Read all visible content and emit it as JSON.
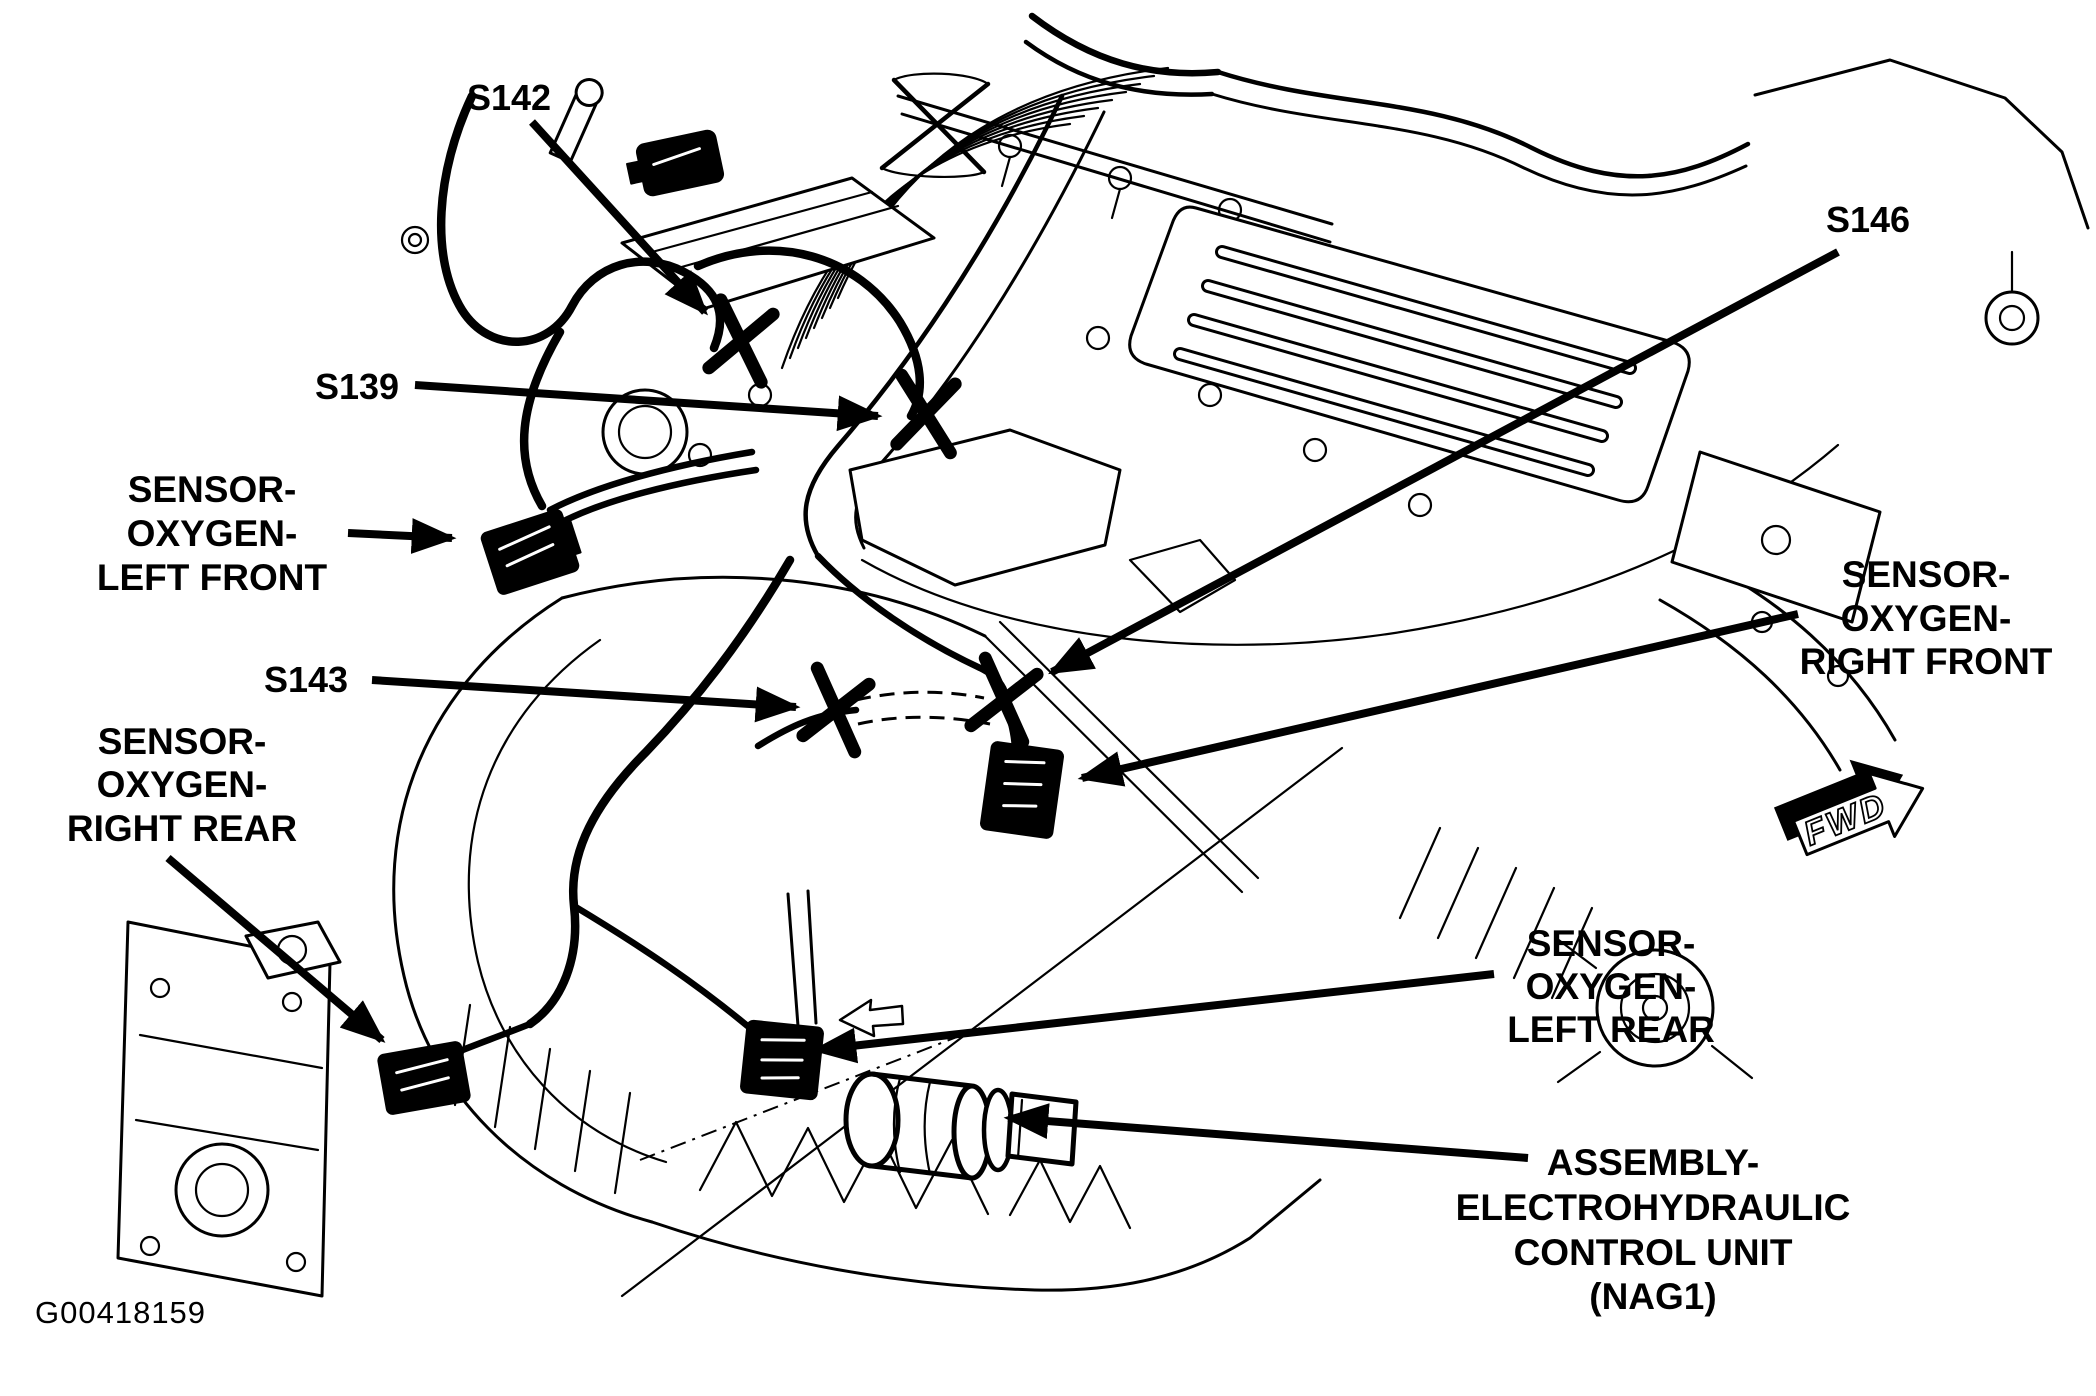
{
  "figure": {
    "drawing_number": "G00418159",
    "description": "Engine and transmission wiring harness view - oxygen sensor and splice locations",
    "colors": {
      "ink": "#000000",
      "paper": "#ffffff"
    }
  },
  "direction_indicator": {
    "label": "FWD"
  },
  "splice_callouts": [
    {
      "id": "S142"
    },
    {
      "id": "S139"
    },
    {
      "id": "S143"
    },
    {
      "id": "S146"
    }
  ],
  "component_callouts": [
    {
      "name": "SENSOR-OXYGEN-LEFT FRONT",
      "lines": [
        "SENSOR-",
        "OXYGEN-",
        "LEFT FRONT"
      ]
    },
    {
      "name": "SENSOR-OXYGEN-RIGHT REAR",
      "lines": [
        "SENSOR-",
        "OXYGEN-",
        "RIGHT REAR"
      ]
    },
    {
      "name": "SENSOR-OXYGEN-RIGHT FRONT",
      "lines": [
        "SENSOR-",
        "OXYGEN-",
        "RIGHT FRONT"
      ]
    },
    {
      "name": "SENSOR-OXYGEN-LEFT REAR",
      "lines": [
        "SENSOR-",
        "OXYGEN-",
        "LEFT REAR"
      ]
    },
    {
      "name": "ASSEMBLY-ELECTROHYDRAULIC CONTROL UNIT (NAG1)",
      "lines": [
        "ASSEMBLY-",
        "ELECTROHYDRAULIC",
        "CONTROL UNIT",
        "(NAG1)"
      ]
    }
  ]
}
